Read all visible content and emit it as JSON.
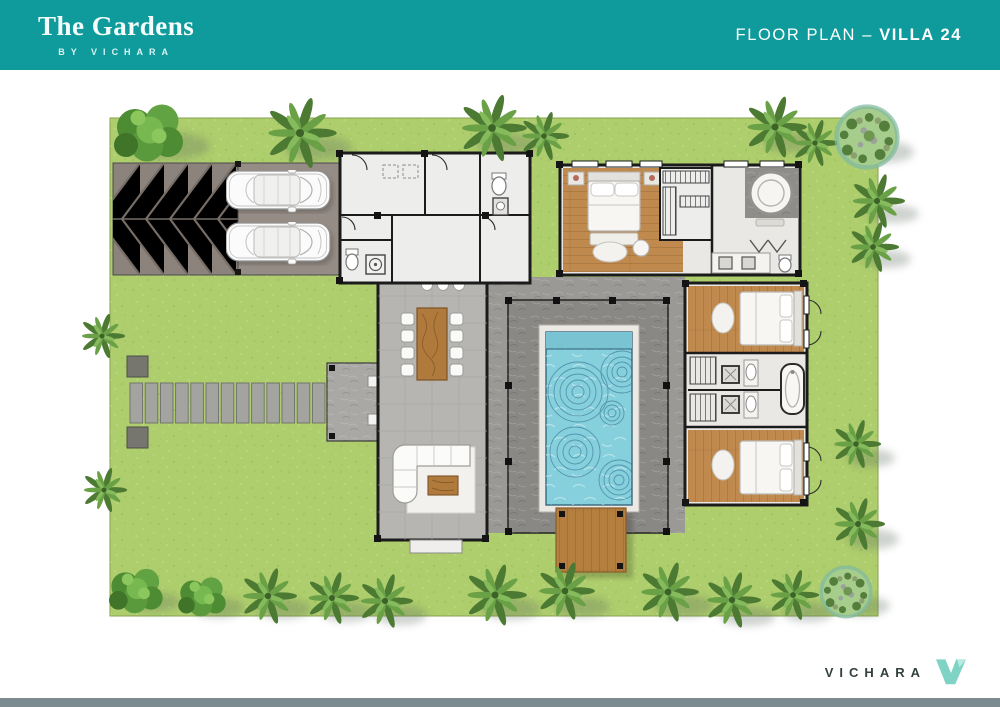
{
  "header": {
    "brand_title": "The Gardens",
    "brand_subtitle": "BY VICHARA",
    "page_label": "FLOOR PLAN – ",
    "page_label_emphasis": "VILLA 24",
    "background_color": "#0f9b9c"
  },
  "footer": {
    "brand_name": "VICHARA",
    "accent_bar_color": "#7c8b8f",
    "logo_color": "#7fd3c5",
    "text_color": "#33403f"
  },
  "plan": {
    "name": "villa-24-site-plan",
    "palette": {
      "lawn": "#aecd6c",
      "driveway": "#8c837c",
      "parking_slab": "#958c85",
      "pool_water": "#86cfdc",
      "pool_border": "#ece9e4",
      "pool_deck": "#8a8885",
      "paving": "#9b9995",
      "wood_floor": "#c08a4e",
      "timber_deck": "#b5803f",
      "interior_floor": "#ededeb",
      "bath_floor": "#e9e8e5",
      "hall_tile": "#b6b5b1",
      "wall": "#1b1b1b",
      "palm_green": "#55843a",
      "bush_green": "#4e8c33",
      "stepping_stone": "#a3a3a0"
    },
    "features": [
      "garden-lawn",
      "chevron-driveway",
      "parked-cars",
      "stepping-stone-path",
      "entry-patio",
      "service-rooms",
      "kitchen",
      "dining-area",
      "living-area",
      "master-bedroom",
      "walk-in-closet",
      "master-bathroom",
      "bedroom-2",
      "shared-bathroom",
      "bedroom-3",
      "swimming-pool",
      "pool-deck",
      "timber-deck",
      "palm-trees",
      "garden-mounds"
    ]
  }
}
